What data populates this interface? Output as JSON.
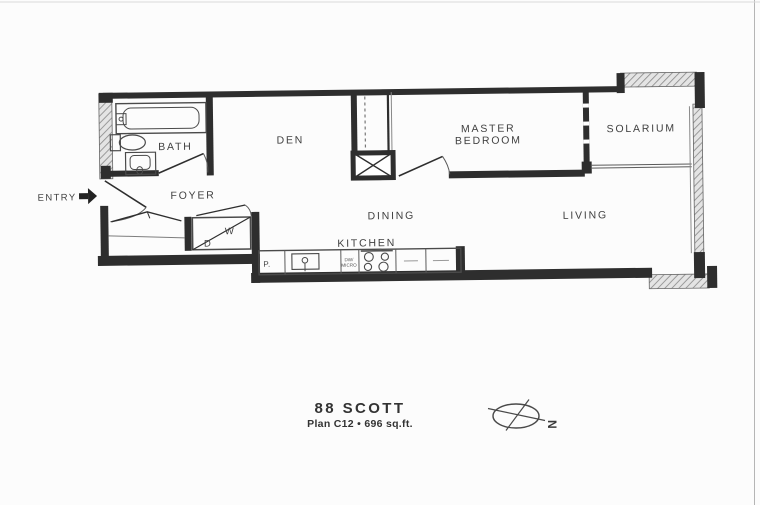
{
  "plan": {
    "title": "88 SCOTT",
    "subtitle": "Plan C12 • 696 sq.ft.",
    "rooms": {
      "bath": "BATH",
      "den": "DEN",
      "master_line1": "MASTER",
      "master_line2": "BEDROOM",
      "solarium": "SOLARIUM",
      "entry": "ENTRY",
      "foyer": "FOYER",
      "dining": "DINING",
      "living": "LIVING",
      "kitchen": "KITCHEN"
    },
    "fixtures": {
      "washer": "W",
      "dryer": "D",
      "pantry": "P.",
      "dw_line1": "DW/",
      "dw_line2": "MICRO"
    },
    "compass": {
      "north": "N"
    },
    "colors": {
      "wall": "#2e2e2e",
      "text": "#3f3f3f",
      "paper": "#fcfcfc",
      "thin": "#5a5a5a",
      "artifact": "#b5b5b5"
    }
  }
}
